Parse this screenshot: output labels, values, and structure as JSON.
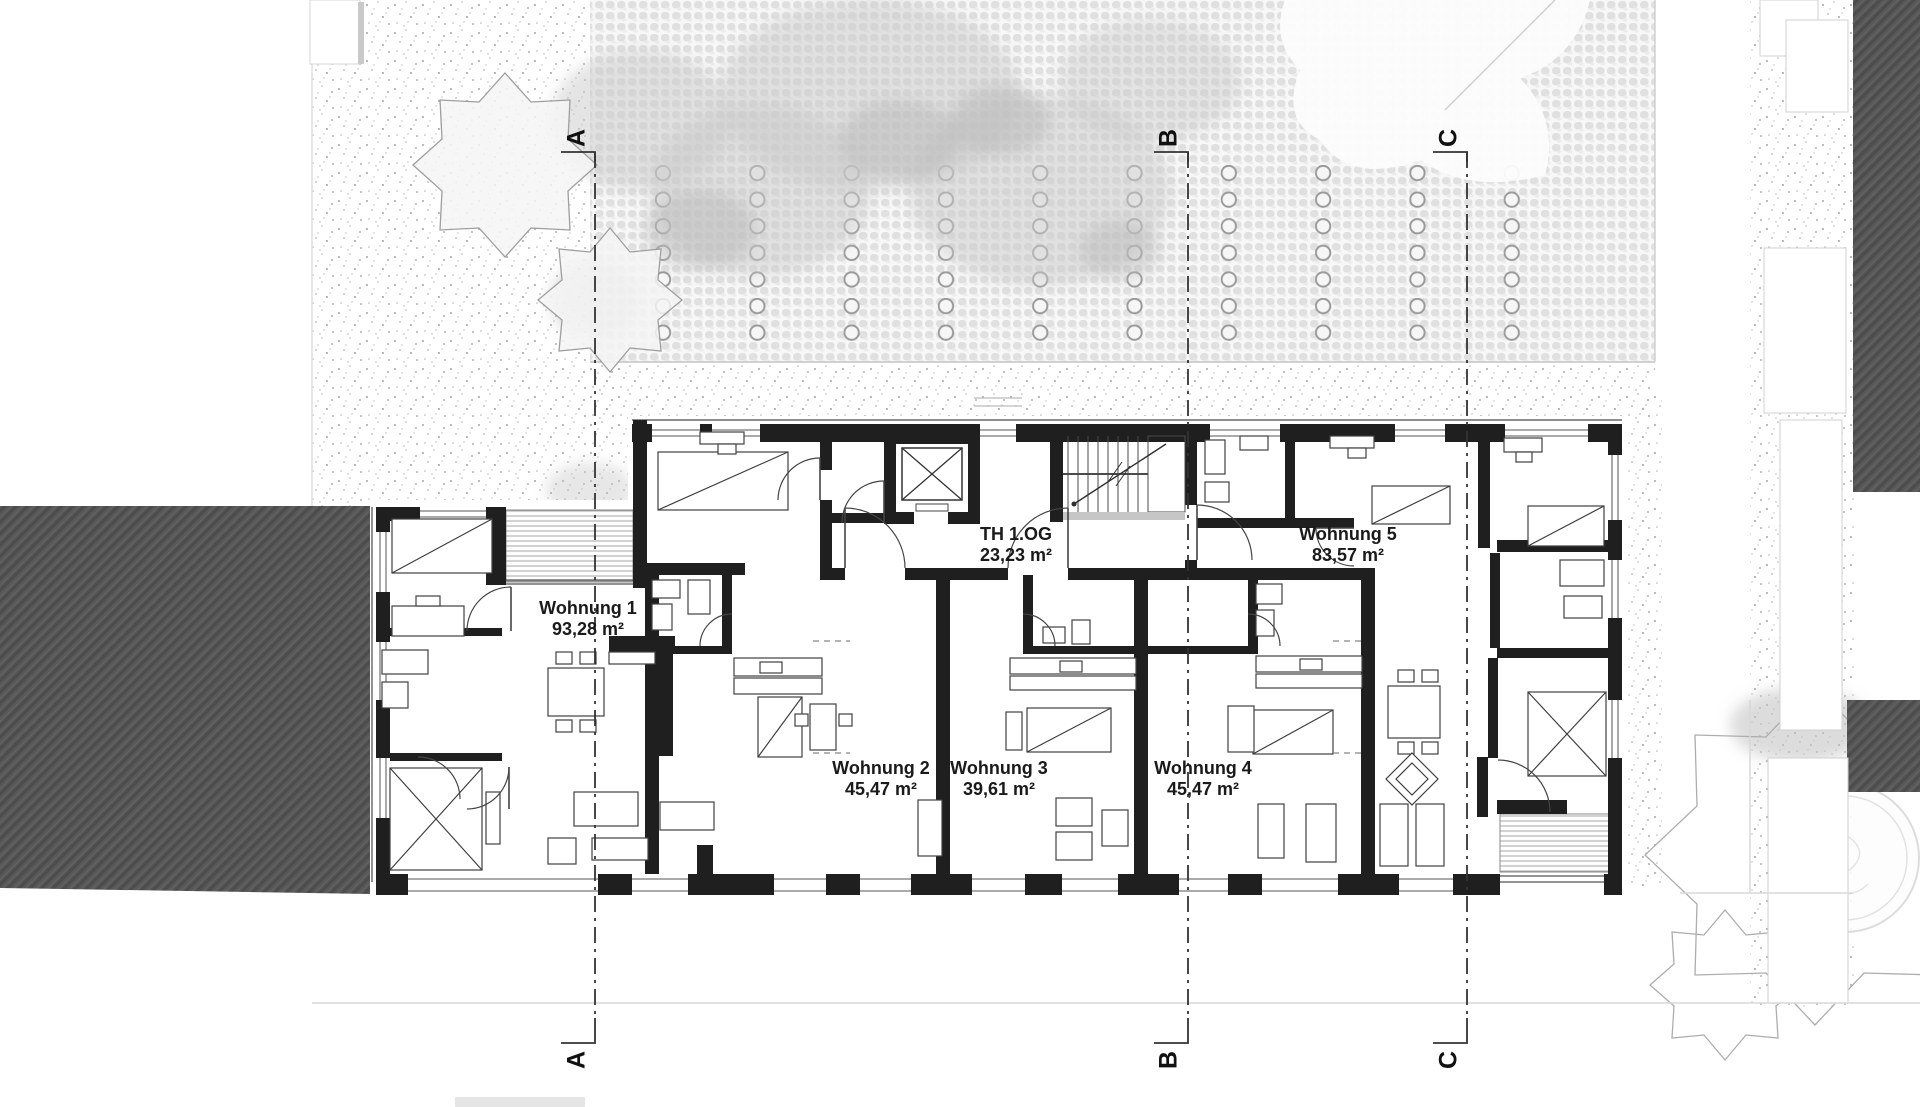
{
  "drawing": {
    "stairwell_label": {
      "name": "TH 1.OG",
      "area": "23,23 m²"
    },
    "apartments": [
      {
        "name": "Wohnung 1",
        "area": "93,28 m²"
      },
      {
        "name": "Wohnung 2",
        "area": "45,47 m²"
      },
      {
        "name": "Wohnung 3",
        "area": "39,61 m²"
      },
      {
        "name": "Wohnung 4",
        "area": "45,47 m²"
      },
      {
        "name": "Wohnung 5",
        "area": "83,57 m²"
      }
    ],
    "section_markers": [
      {
        "label": "A"
      },
      {
        "label": "B"
      },
      {
        "label": "C"
      }
    ]
  },
  "colors": {
    "wall": "#1f1f1f",
    "roof_hatch": "#585858",
    "paving_blob": "#e0e0e0",
    "ring_stroke": "#9a9a9a",
    "text": "#1a1a1a"
  }
}
